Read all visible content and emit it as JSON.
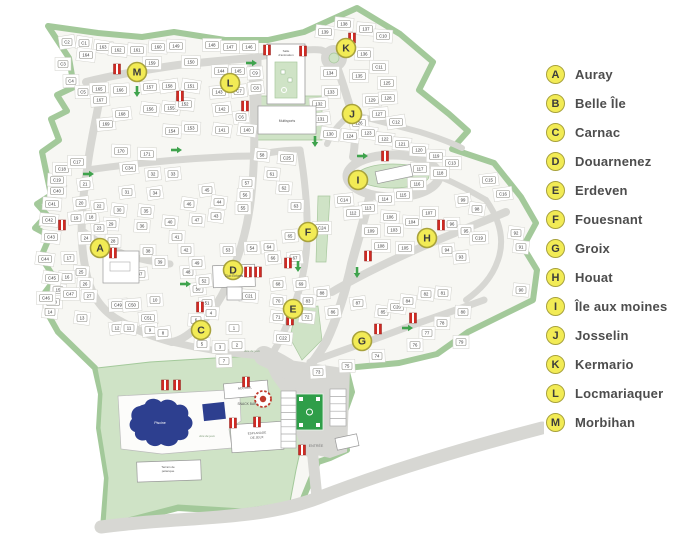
{
  "legend": {
    "items": [
      {
        "letter": "A",
        "label": "Auray"
      },
      {
        "letter": "B",
        "label": "Belle Île"
      },
      {
        "letter": "C",
        "label": "Carnac"
      },
      {
        "letter": "D",
        "label": "Douarnenez"
      },
      {
        "letter": "E",
        "label": "Erdeven"
      },
      {
        "letter": "F",
        "label": "Fouesnant"
      },
      {
        "letter": "G",
        "label": "Groix"
      },
      {
        "letter": "H",
        "label": "Houat"
      },
      {
        "letter": "I",
        "label": "Île aux moines"
      },
      {
        "letter": "J",
        "label": "Josselin"
      },
      {
        "letter": "K",
        "label": "Kermario"
      },
      {
        "letter": "L",
        "label": "Locmariaquer"
      },
      {
        "letter": "M",
        "label": "Morbihan"
      }
    ]
  },
  "map": {
    "colors": {
      "site_green": "#cfe3c6",
      "hedge": "#a3c99a",
      "road": "#d7d7d3",
      "marker_yellow": "#f2eb55",
      "marker_border": "#a8a23c",
      "hydrant_red": "#cf2b24",
      "pool_blue": "#2d3f8f",
      "court_green": "#2f9e49",
      "legend_text": "#4d4d4d"
    },
    "markers": [
      {
        "letter": "A",
        "x": 100,
        "y": 248
      },
      {
        "letter": "C",
        "x": 201,
        "y": 330
      },
      {
        "letter": "D",
        "x": 233,
        "y": 270
      },
      {
        "letter": "E",
        "x": 293,
        "y": 309
      },
      {
        "letter": "F",
        "x": 308,
        "y": 232
      },
      {
        "letter": "G",
        "x": 362,
        "y": 341
      },
      {
        "letter": "H",
        "x": 427,
        "y": 238
      },
      {
        "letter": "I",
        "x": 358,
        "y": 180
      },
      {
        "letter": "J",
        "x": 352,
        "y": 114
      },
      {
        "letter": "K",
        "x": 346,
        "y": 48
      },
      {
        "letter": "L",
        "x": 230,
        "y": 83
      },
      {
        "letter": "M",
        "x": 137,
        "y": 72
      }
    ],
    "plots": [
      [
        "C2",
        67,
        42
      ],
      [
        "C1",
        84,
        43
      ],
      [
        "163",
        103,
        47
      ],
      [
        "164",
        86,
        55
      ],
      [
        "162",
        118,
        50
      ],
      [
        "161",
        137,
        50
      ],
      [
        "160",
        158,
        47
      ],
      [
        "149",
        176,
        46
      ],
      [
        "150",
        191,
        62
      ],
      [
        "159",
        152,
        63
      ],
      [
        "C3",
        63,
        64
      ],
      [
        "C4",
        71,
        81
      ],
      [
        "C5",
        83,
        92
      ],
      [
        "165",
        99,
        89
      ],
      [
        "166",
        120,
        90
      ],
      [
        "167",
        100,
        100
      ],
      [
        "169",
        106,
        124
      ],
      [
        "168",
        122,
        114
      ],
      [
        "157",
        150,
        87
      ],
      [
        "158",
        169,
        86
      ],
      [
        "151",
        191,
        86
      ],
      [
        "156",
        150,
        109
      ],
      [
        "155",
        171,
        108
      ],
      [
        "152",
        185,
        104
      ],
      [
        "154",
        172,
        131
      ],
      [
        "153",
        191,
        128
      ],
      [
        "170",
        121,
        151
      ],
      [
        "171",
        147,
        154
      ],
      [
        "148",
        212,
        45
      ],
      [
        "147",
        230,
        47
      ],
      [
        "146",
        249,
        47
      ],
      [
        "144",
        221,
        71
      ],
      [
        "145",
        238,
        71
      ],
      [
        "C9",
        255,
        73
      ],
      [
        "143",
        219,
        92
      ],
      [
        "C7",
        239,
        91
      ],
      [
        "C8",
        256,
        88
      ],
      [
        "142",
        222,
        109
      ],
      [
        "C6",
        241,
        117
      ],
      [
        "141",
        222,
        130
      ],
      [
        "140",
        247,
        130
      ],
      [
        "139",
        325,
        32
      ],
      [
        "138",
        344,
        24
      ],
      [
        "137",
        366,
        29
      ],
      [
        "C10",
        383,
        36
      ],
      [
        "136",
        364,
        54
      ],
      [
        "C11",
        379,
        67
      ],
      [
        "135",
        359,
        76
      ],
      [
        "134",
        330,
        73
      ],
      [
        "125",
        387,
        83
      ],
      [
        "133",
        331,
        92
      ],
      [
        "129",
        372,
        100
      ],
      [
        "128",
        388,
        98
      ],
      [
        "132",
        319,
        104
      ],
      [
        "127",
        379,
        114
      ],
      [
        "131",
        321,
        119
      ],
      [
        "126",
        359,
        123
      ],
      [
        "C12",
        396,
        122
      ],
      [
        "130",
        330,
        134
      ],
      [
        "124",
        350,
        136
      ],
      [
        "123",
        368,
        133
      ],
      [
        "122",
        385,
        139
      ],
      [
        "121",
        402,
        144
      ],
      [
        "120",
        419,
        150
      ],
      [
        "119",
        436,
        156
      ],
      [
        "C13",
        452,
        163
      ],
      [
        "118",
        440,
        173
      ],
      [
        "117",
        420,
        169
      ],
      [
        "116",
        417,
        184
      ],
      [
        "115",
        403,
        195
      ],
      [
        "114",
        385,
        199
      ],
      [
        "113",
        368,
        208
      ],
      [
        "112",
        353,
        213
      ],
      [
        "C14",
        344,
        200
      ],
      [
        "C15",
        489,
        180
      ],
      [
        "C16",
        503,
        194
      ],
      [
        "99",
        463,
        200
      ],
      [
        "98",
        477,
        209
      ],
      [
        "92",
        516,
        233
      ],
      [
        "91",
        521,
        247
      ],
      [
        "90",
        521,
        290
      ],
      [
        "106",
        390,
        217
      ],
      [
        "104",
        412,
        222
      ],
      [
        "103",
        394,
        230
      ],
      [
        "109",
        371,
        231
      ],
      [
        "108",
        381,
        246
      ],
      [
        "105",
        405,
        248
      ],
      [
        "107",
        429,
        213
      ],
      [
        "96",
        452,
        224
      ],
      [
        "95",
        466,
        231
      ],
      [
        "C19",
        479,
        238
      ],
      [
        "94",
        447,
        250
      ],
      [
        "93",
        461,
        257
      ],
      [
        "88",
        322,
        293
      ],
      [
        "86",
        333,
        312
      ],
      [
        "87",
        358,
        303
      ],
      [
        "85",
        383,
        312
      ],
      [
        "C20",
        397,
        307
      ],
      [
        "84",
        408,
        301
      ],
      [
        "82",
        426,
        294
      ],
      [
        "81",
        443,
        293
      ],
      [
        "83",
        308,
        301
      ],
      [
        "80",
        463,
        312
      ],
      [
        "78",
        442,
        323
      ],
      [
        "77",
        427,
        333
      ],
      [
        "79",
        461,
        342
      ],
      [
        "76",
        415,
        345
      ],
      [
        "75",
        347,
        366
      ],
      [
        "74",
        377,
        356
      ],
      [
        "73",
        318,
        372
      ],
      [
        "32",
        153,
        174
      ],
      [
        "33",
        173,
        174
      ],
      [
        "C34",
        129,
        168
      ],
      [
        "31",
        127,
        192
      ],
      [
        "34",
        155,
        193
      ],
      [
        "46",
        189,
        204
      ],
      [
        "30",
        119,
        210
      ],
      [
        "35",
        146,
        211
      ],
      [
        "40",
        170,
        222
      ],
      [
        "47",
        197,
        220
      ],
      [
        "29",
        111,
        224
      ],
      [
        "36",
        142,
        226
      ],
      [
        "41",
        177,
        237
      ],
      [
        "28",
        113,
        241
      ],
      [
        "38",
        148,
        251
      ],
      [
        "42",
        186,
        250
      ],
      [
        "39",
        160,
        262
      ],
      [
        "48",
        188,
        272
      ],
      [
        "49",
        197,
        263
      ],
      [
        "37",
        140,
        274
      ],
      [
        "50",
        198,
        289
      ],
      [
        "52",
        204,
        281
      ],
      [
        "51",
        207,
        303
      ],
      [
        "45",
        207,
        190
      ],
      [
        "44",
        219,
        202
      ],
      [
        "43",
        216,
        216
      ],
      [
        "58",
        262,
        155
      ],
      [
        "C25",
        287,
        158
      ],
      [
        "61",
        272,
        174
      ],
      [
        "62",
        284,
        188
      ],
      [
        "57",
        247,
        183
      ],
      [
        "56",
        245,
        195
      ],
      [
        "63",
        296,
        206
      ],
      [
        "55",
        243,
        208
      ],
      [
        "C24",
        322,
        228
      ],
      [
        "53",
        228,
        250
      ],
      [
        "54",
        252,
        248
      ],
      [
        "64",
        269,
        247
      ],
      [
        "65",
        290,
        236
      ],
      [
        "66",
        273,
        258
      ],
      [
        "67",
        295,
        258
      ],
      [
        "68",
        278,
        284
      ],
      [
        "69",
        301,
        284
      ],
      [
        "70",
        278,
        301
      ],
      [
        "71",
        278,
        317
      ],
      [
        "72",
        307,
        317
      ],
      [
        "C22",
        283,
        338
      ],
      [
        "C21",
        249,
        296
      ],
      [
        "4",
        211,
        313
      ],
      [
        "6",
        196,
        320
      ],
      [
        "5",
        202,
        344
      ],
      [
        "3",
        220,
        347
      ],
      [
        "1",
        234,
        328
      ],
      [
        "2",
        237,
        345
      ],
      [
        "7",
        224,
        361
      ],
      [
        "10",
        155,
        300
      ],
      [
        "C49",
        118,
        305
      ],
      [
        "C50",
        132,
        305
      ],
      [
        "C51",
        148,
        318
      ],
      [
        "9",
        150,
        330
      ],
      [
        "8",
        163,
        333
      ],
      [
        "12",
        117,
        328
      ],
      [
        "11",
        129,
        328
      ],
      [
        "13",
        82,
        318
      ],
      [
        "14",
        50,
        312
      ],
      [
        "15",
        58,
        290
      ],
      [
        "25",
        81,
        272
      ],
      [
        "26",
        85,
        284
      ],
      [
        "27",
        89,
        296
      ],
      [
        "C48",
        53,
        302
      ],
      [
        "C47",
        70,
        294
      ],
      [
        "C46",
        46,
        298
      ],
      [
        "16",
        67,
        277
      ],
      [
        "17",
        69,
        258
      ],
      [
        "24",
        86,
        238
      ],
      [
        "23",
        99,
        228
      ],
      [
        "18",
        91,
        217
      ],
      [
        "19",
        76,
        218
      ],
      [
        "20",
        81,
        203
      ],
      [
        "22",
        99,
        206
      ],
      [
        "21",
        85,
        184
      ],
      [
        "C45",
        52,
        278
      ],
      [
        "C44",
        45,
        259
      ],
      [
        "C43",
        51,
        237
      ],
      [
        "C42",
        49,
        220
      ],
      [
        "C41",
        52,
        204
      ],
      [
        "C40",
        57,
        191
      ],
      [
        "C19",
        57,
        180
      ],
      [
        "C18",
        62,
        169
      ],
      [
        "C17",
        77,
        162
      ]
    ],
    "hydrants": [
      [
        117,
        69
      ],
      [
        180,
        96
      ],
      [
        267,
        50
      ],
      [
        303,
        51
      ],
      [
        352,
        38
      ],
      [
        245,
        106
      ],
      [
        62,
        225
      ],
      [
        113,
        253
      ],
      [
        200,
        307
      ],
      [
        248,
        272
      ],
      [
        258,
        272
      ],
      [
        288,
        263
      ],
      [
        290,
        320
      ],
      [
        385,
        156
      ],
      [
        441,
        225
      ],
      [
        368,
        256
      ],
      [
        378,
        329
      ],
      [
        413,
        318
      ],
      [
        165,
        385
      ],
      [
        177,
        385
      ],
      [
        246,
        382
      ],
      [
        233,
        423
      ],
      [
        257,
        422
      ],
      [
        302,
        450
      ]
    ],
    "arrows": [
      [
        137,
        92,
        "d"
      ],
      [
        177,
        150,
        "r"
      ],
      [
        315,
        142,
        "d"
      ],
      [
        89,
        174,
        "r"
      ],
      [
        186,
        284,
        "r"
      ],
      [
        298,
        267,
        "d"
      ],
      [
        363,
        156,
        "r"
      ],
      [
        357,
        273,
        "d"
      ],
      [
        408,
        328,
        "r"
      ],
      [
        252,
        63,
        "r"
      ]
    ],
    "labels": [
      [
        "Salle",
        286,
        52,
        3,
        "#555",
        0,
        0
      ],
      [
        "d'animation",
        286,
        56,
        3,
        "#555",
        0,
        0
      ],
      [
        "Multisports",
        287,
        122,
        3.4,
        "#555",
        0,
        0
      ],
      [
        "Club Enfants",
        234,
        277,
        3.2,
        "#555",
        0,
        0
      ],
      [
        "ACCUEIL",
        245,
        389,
        3.3,
        "#555",
        0,
        -5
      ],
      [
        "SNACK BAR",
        247,
        405,
        3.3,
        "#555",
        0,
        0
      ],
      [
        "ESPLANADE",
        257,
        434,
        3.1,
        "#555",
        0,
        -3
      ],
      [
        "DE JEUX",
        257,
        438.5,
        3.1,
        "#555",
        0,
        -3
      ],
      [
        "ENTRÉE",
        316,
        447,
        3.6,
        "#777",
        0,
        0
      ],
      [
        "Piscine",
        160,
        424,
        3.6,
        "#ffffff",
        0,
        0
      ],
      [
        "Terrain de",
        168,
        468,
        3,
        "#555",
        0,
        0
      ],
      [
        "pétanque",
        168,
        472,
        3,
        "#555",
        0,
        0
      ],
      [
        "Aire de jeux",
        207,
        437,
        3,
        "#7d9b78",
        1,
        0
      ],
      [
        "Aire de jeux",
        252,
        352,
        3,
        "#7d9b78",
        1,
        0
      ]
    ]
  }
}
